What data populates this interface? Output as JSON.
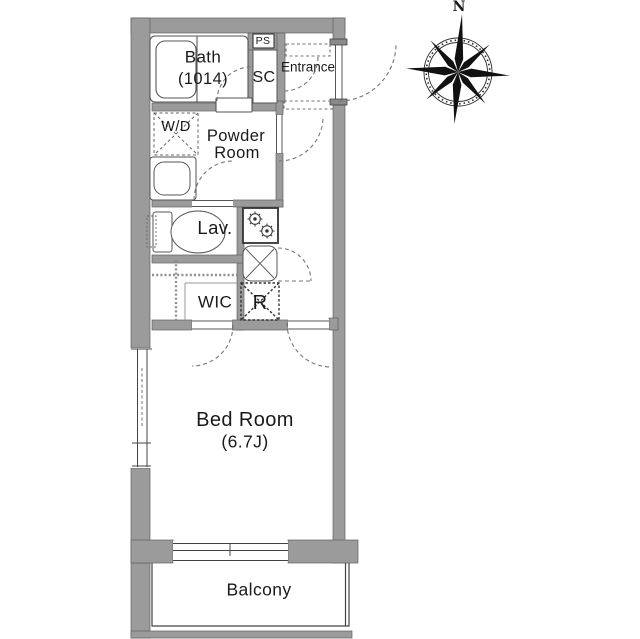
{
  "floor_plan": {
    "rooms": {
      "bath": {
        "label": "Bath",
        "size": "(1014)"
      },
      "powder_room": {
        "label_line1": "Powder",
        "label_line2": "Room"
      },
      "lavatory": {
        "label": "Lav."
      },
      "wic": {
        "label": "WIC"
      },
      "bedroom": {
        "label": "Bed Room",
        "size": "(6.7J)"
      },
      "entrance": {
        "label": "Entrance"
      },
      "balcony": {
        "label": "Balcony"
      }
    },
    "fixtures": {
      "pipe_space": {
        "label": "PS"
      },
      "shoe_closet": {
        "label": "SC"
      },
      "washer_dryer": {
        "label": "W/D"
      },
      "refrigerator": {
        "label": "R"
      }
    },
    "compass": {
      "north_label": "N"
    },
    "colors": {
      "wall_fill": "#9b9b9b",
      "line": "#444444",
      "dash": "#777777",
      "background": "#ffffff",
      "text": "#1a1a1a"
    }
  }
}
